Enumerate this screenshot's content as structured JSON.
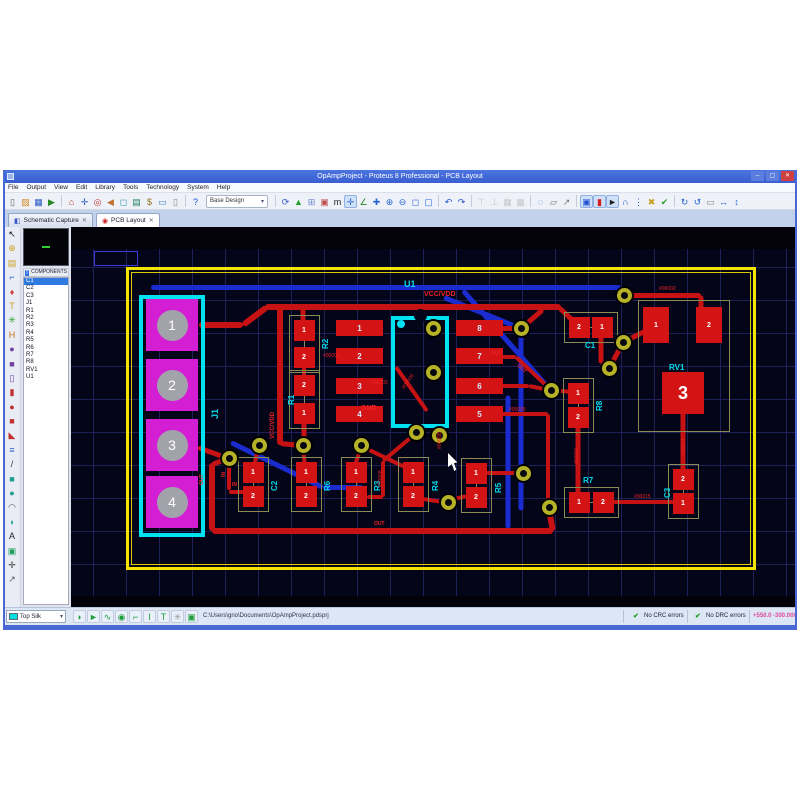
{
  "window": {
    "title": "OpAmpProject - Proteus 8 Professional - PCB Layout",
    "minimize_label": "–",
    "maximize_label": "▢",
    "close_label": "✕"
  },
  "menu": {
    "items": [
      "File",
      "Output",
      "View",
      "Edit",
      "Library",
      "Tools",
      "Technology",
      "System",
      "Help"
    ]
  },
  "toolbar": {
    "base_design": "Base Design",
    "icons": [
      [
        "new-file",
        "▯",
        "#666"
      ],
      [
        "open-project",
        "▨",
        "#d08820"
      ],
      [
        "save-project",
        "▦",
        "#2858c8"
      ],
      [
        "import-section",
        "▶",
        "#288828"
      ],
      [
        "sep"
      ],
      [
        "home",
        "⌂",
        "#b04030"
      ],
      [
        "goto-sheet",
        "✛",
        "#2858c8"
      ],
      [
        "center-at",
        "◎",
        "#c03030"
      ],
      [
        "undo-view",
        "◀",
        "#c07030"
      ],
      [
        "zoom-view",
        "◻",
        "#2898a8"
      ],
      [
        "design-explorer",
        "▤",
        "#208060"
      ],
      [
        "bill-of-materials",
        "$",
        "#907020"
      ],
      [
        "electrical-rule-check",
        "▭",
        "#4080c0"
      ],
      [
        "new-sheet",
        "▯",
        "#888"
      ],
      [
        "sep"
      ],
      [
        "help",
        "?",
        "#1850d0"
      ],
      [
        "select-base-design"
      ],
      [
        "sep"
      ],
      [
        "redraw",
        "⟳",
        "#2858c8"
      ],
      [
        "flip-layer",
        "▲",
        "#28a028"
      ],
      [
        "grid-toggle",
        "⊞",
        "#6888c8"
      ],
      [
        "layer-colours",
        "▣",
        "#c05050"
      ],
      [
        "metric-toggle",
        "m",
        "#222"
      ],
      [
        "origin",
        "✛",
        "#2868d8",
        "s"
      ],
      [
        "x-cursor",
        "∠",
        "#288828"
      ],
      [
        "pan",
        "✚",
        "#2868d8"
      ],
      [
        "zoom-in",
        "⊕",
        "#2868d8"
      ],
      [
        "zoom-out",
        "⊖",
        "#2868d8"
      ],
      [
        "zoom-area",
        "◻",
        "#2868d8"
      ],
      [
        "zoom-all",
        "▢",
        "#2868d8"
      ],
      [
        "sep"
      ],
      [
        "undo",
        "↶",
        "#2050d0"
      ],
      [
        "redo",
        "↷",
        "#2050d0"
      ],
      [
        "sep"
      ],
      [
        "align-top",
        "⊤",
        "#999",
        "d"
      ],
      [
        "align-bottom",
        "⊥",
        "#999",
        "d"
      ],
      [
        "align-left",
        "▦",
        "#999",
        "d"
      ],
      [
        "align-right",
        "▩",
        "#999",
        "d"
      ],
      [
        "sep"
      ],
      [
        "search-tag",
        "◌",
        "#2868d8"
      ],
      [
        "copy-clip",
        "▱",
        "#777"
      ],
      [
        "tools",
        "↗",
        "#777"
      ],
      [
        "sep"
      ],
      [
        "trace-lock",
        "▣",
        "#2050d0",
        "s"
      ],
      [
        "pin-mode",
        "▮",
        "#d02020",
        "s"
      ],
      [
        "selection-filter",
        "►",
        "#222",
        "s"
      ],
      [
        "auto-router",
        "∩",
        "#2050d0"
      ],
      [
        "design-rule-manager",
        "⋮",
        "#2050d0"
      ],
      [
        "ratsnest-toggle",
        "✖",
        "#c8a020"
      ],
      [
        "connectivity-check",
        "✔",
        "#28a028"
      ],
      [
        "sep"
      ],
      [
        "rotate-cw",
        "↻",
        "#2060d0"
      ],
      [
        "rotate-ccw",
        "↺",
        "#2060d0"
      ],
      [
        "rotation-value",
        "▭",
        "#888"
      ],
      [
        "flip-horizontal",
        "↔",
        "#2060d0"
      ],
      [
        "flip-vertical",
        "↕",
        "#2060d0"
      ]
    ]
  },
  "tabs": [
    {
      "label": "Schematic Capture",
      "icon_glyph": "◧",
      "icon_color": "#3a58c8",
      "close": "✕",
      "active": false
    },
    {
      "label": "PCB Layout",
      "icon_glyph": "◉",
      "icon_color": "#cc2222",
      "close": "✕",
      "active": true
    }
  ],
  "sidebar": {
    "panel_title": "COMPONENTS",
    "header_icon": "T",
    "selected": "C1",
    "components": [
      "C1",
      "C2",
      "C3",
      "J1",
      "R1",
      "R2",
      "R3",
      "R4",
      "R5",
      "R6",
      "R7",
      "R8",
      "RV1",
      "U1"
    ],
    "tool_icons": [
      [
        "selection-mode",
        "↖",
        "#111"
      ],
      [
        "component-mode",
        "⊕",
        "#c8a020"
      ],
      [
        "package-mode",
        "▤",
        "#c8a020"
      ],
      [
        "track-mode",
        "⌐",
        "#2858d8"
      ],
      [
        "via-mode",
        "♦",
        "#d04040"
      ],
      [
        "zone-mode",
        "T",
        "#c8a020"
      ],
      [
        "ratsnest-mode",
        "✳",
        "#28a028"
      ],
      [
        "connectivity-highlight-mode",
        "H",
        "#c87020"
      ],
      [
        "round-pad-mode",
        "●",
        "#7040a0"
      ],
      [
        "square-pad-mode",
        "■",
        "#7040a0"
      ],
      [
        "dil-pad-mode",
        "▯",
        "#7040a0"
      ],
      [
        "edge-pad-mode",
        "▮",
        "#c03030"
      ],
      [
        "circular-pad-mode",
        "●",
        "#c03030"
      ],
      [
        "rect-pad-mode",
        "■",
        "#c03030"
      ],
      [
        "polygonal-pad-mode",
        "◣",
        "#c03030"
      ],
      [
        "layer-stack",
        "≡",
        "#3060d0"
      ],
      [
        "2d-line",
        "/",
        "#333"
      ],
      [
        "2d-box",
        "■",
        "#1f9e8e"
      ],
      [
        "2d-circle",
        "●",
        "#1f9e8e"
      ],
      [
        "2d-arc",
        "◠",
        "#555"
      ],
      [
        "2d-path",
        "◗",
        "#1f9e8e"
      ],
      [
        "2d-text",
        "A",
        "#222"
      ],
      [
        "2d-symbol",
        "▣",
        "#1f9e60"
      ],
      [
        "origin-marker",
        "✛",
        "#333"
      ],
      [
        "dimension-mode",
        "↗",
        "#555"
      ]
    ]
  },
  "statusbar": {
    "layer_selector": "Top Silk",
    "layer_swatch": "#00e0e0",
    "icons": [
      [
        "layer-flip",
        "◗",
        "#1f9e3e"
      ],
      [
        "track-arrow",
        "►",
        "#1f9e3e"
      ],
      [
        "trace-style",
        "∿",
        "#1f9e3e"
      ],
      [
        "via-style",
        "◉",
        "#1f9e3e"
      ],
      [
        "corner-mode",
        "⌐",
        "#1f9e3e"
      ],
      [
        "track-width",
        "I",
        "#1f9e3e"
      ],
      [
        "tee-junction",
        "T",
        "#1f9e3e"
      ],
      [
        "ratsnest-view",
        "✳",
        "#999"
      ],
      [
        "log-view",
        "▣",
        "#1f9e3e"
      ]
    ],
    "file_path": "C:\\Users\\gno\\Documents\\OpAmpProject.pdsprj",
    "crc_check": "✔",
    "crc_status": "No CRC errors",
    "drc_check": "✔",
    "drc_status": "No DRC errors",
    "coord_x": "+550.0",
    "coord_y": "-300.0",
    "coord_units": "th"
  },
  "pcb": {
    "board": {
      "x": 55,
      "y": 40,
      "w": 630,
      "h": 303
    },
    "selection_box": {
      "x": 23,
      "y": 24,
      "w": 44,
      "h": 15
    },
    "traces_blue": [
      [
        80,
        60,
        550,
        60,
        5
      ],
      [
        373,
        70,
        450,
        101,
        5
      ],
      [
        450,
        101,
        450,
        246,
        5
      ],
      [
        392,
        63,
        478,
        161,
        5
      ],
      [
        437,
        168,
        437,
        301,
        5
      ],
      [
        160,
        215,
        252,
        260,
        5
      ],
      [
        252,
        260,
        292,
        260,
        5
      ],
      [
        450,
        246,
        450,
        283,
        5
      ]
    ],
    "traces_red": [
      [
        128,
        98,
        172,
        98,
        6
      ],
      [
        172,
        98,
        196,
        80,
        6
      ],
      [
        194,
        80,
        490,
        80,
        6
      ],
      [
        488,
        80,
        506,
        97,
        5
      ],
      [
        232,
        80,
        232,
        103,
        5
      ],
      [
        209,
        80,
        209,
        218,
        6
      ],
      [
        209,
        216,
        230,
        218,
        5
      ],
      [
        233,
        190,
        233,
        216,
        5
      ],
      [
        233,
        132,
        233,
        158,
        4
      ],
      [
        430,
        101,
        450,
        101,
        5
      ],
      [
        450,
        101,
        472,
        82,
        5
      ],
      [
        530,
        104,
        530,
        136,
        5
      ],
      [
        530,
        136,
        538,
        141,
        4
      ],
      [
        538,
        141,
        552,
        115,
        5
      ],
      [
        552,
        115,
        583,
        99,
        5
      ],
      [
        553,
        68,
        630,
        68,
        5
      ],
      [
        630,
        68,
        630,
        85,
        5
      ],
      [
        430,
        130,
        445,
        130,
        4
      ],
      [
        445,
        130,
        480,
        163,
        4
      ],
      [
        480,
        163,
        500,
        165,
        4
      ],
      [
        430,
        159,
        458,
        159,
        4
      ],
      [
        458,
        159,
        478,
        163,
        4
      ],
      [
        507,
        193,
        507,
        273,
        5
      ],
      [
        540,
        275,
        603,
        275,
        4
      ],
      [
        612,
        182,
        612,
        251,
        5
      ],
      [
        430,
        187,
        477,
        187,
        4
      ],
      [
        477,
        187,
        477,
        278,
        4
      ],
      [
        141,
        304,
        482,
        304,
        6
      ],
      [
        482,
        304,
        478,
        283,
        6
      ],
      [
        141,
        236,
        141,
        304,
        6
      ],
      [
        141,
        237,
        157,
        231,
        5
      ],
      [
        127,
        220,
        157,
        231,
        5
      ],
      [
        158,
        233,
        158,
        263,
        4
      ],
      [
        158,
        265,
        173,
        265,
        4
      ],
      [
        187,
        222,
        183,
        239,
        4
      ],
      [
        232,
        221,
        234,
        240,
        4
      ],
      [
        290,
        221,
        284,
        238,
        4
      ],
      [
        292,
        220,
        340,
        243,
        4
      ],
      [
        296,
        270,
        312,
        270,
        4
      ],
      [
        312,
        270,
        312,
        234,
        4
      ],
      [
        312,
        234,
        344,
        207,
        4
      ],
      [
        352,
        272,
        372,
        275,
        4
      ],
      [
        379,
        273,
        396,
        269,
        4
      ],
      [
        415,
        246,
        448,
        246,
        4
      ],
      [
        325,
        140,
        356,
        184,
        4
      ]
    ],
    "vias": [
      [
        158,
        231
      ],
      [
        188,
        218
      ],
      [
        232,
        218
      ],
      [
        290,
        218
      ],
      [
        345,
        205
      ],
      [
        368,
        208
      ],
      [
        377,
        275
      ],
      [
        452,
        246
      ],
      [
        478,
        280
      ],
      [
        450,
        101
      ],
      [
        480,
        163
      ],
      [
        538,
        141
      ],
      [
        552,
        115
      ],
      [
        553,
        68
      ],
      [
        362,
        101
      ],
      [
        362,
        145
      ]
    ],
    "j1": {
      "box": [
        68,
        68,
        66,
        242
      ],
      "label": "J1",
      "label_x": 139,
      "label_y": 192,
      "pad_x": 101,
      "pads": [
        {
          "n": "1",
          "y": 98
        },
        {
          "n": "2",
          "y": 158
        },
        {
          "n": "3",
          "y": 218
        },
        {
          "n": "4",
          "y": 275
        }
      ]
    },
    "u1": {
      "box": [
        320,
        89,
        58,
        112
      ],
      "rows": [
        101,
        129,
        159,
        187
      ],
      "left_nums": [
        "1",
        "2",
        "3",
        "4"
      ],
      "right_nums": [
        "8",
        "7",
        "6",
        "5"
      ],
      "pad_left_x": 265,
      "pad_right_x": 385,
      "pad_w": 47,
      "pad_h": 16
    },
    "components": [
      {
        "name": "R2",
        "label_rot": -90,
        "label_x": 250,
        "label_y": 122,
        "pads": [
          {
            "n": "1",
            "x": 233,
            "y": 103
          },
          {
            "n": "2",
            "x": 233,
            "y": 130
          }
        ]
      },
      {
        "name": "R1",
        "label_rot": -90,
        "label_x": 216,
        "label_y": 178,
        "pads": [
          {
            "n": "2",
            "x": 233,
            "y": 158
          },
          {
            "n": "1",
            "x": 233,
            "y": 186
          }
        ]
      },
      {
        "name": "C1",
        "label_rot": 0,
        "label_x": 514,
        "label_y": 114,
        "pads": [
          {
            "n": "2",
            "x": 508,
            "y": 100
          },
          {
            "n": "1",
            "x": 531,
            "y": 100
          }
        ]
      },
      {
        "name": "R8",
        "label_rot": -90,
        "label_x": 524,
        "label_y": 184,
        "pads": [
          {
            "n": "1",
            "x": 507,
            "y": 166
          },
          {
            "n": "2",
            "x": 507,
            "y": 190
          }
        ]
      },
      {
        "name": "C2",
        "label_rot": -90,
        "label_x": 199,
        "label_y": 264,
        "pads": [
          {
            "n": "1",
            "x": 182,
            "y": 245
          },
          {
            "n": "2",
            "x": 182,
            "y": 269
          }
        ]
      },
      {
        "name": "R6",
        "label_rot": -90,
        "label_x": 252,
        "label_y": 264,
        "pads": [
          {
            "n": "1",
            "x": 235,
            "y": 245
          },
          {
            "n": "2",
            "x": 235,
            "y": 269
          }
        ]
      },
      {
        "name": "R3",
        "label_rot": -90,
        "label_x": 302,
        "label_y": 264,
        "pads": [
          {
            "n": "1",
            "x": 285,
            "y": 245
          },
          {
            "n": "2",
            "x": 285,
            "y": 269
          }
        ]
      },
      {
        "name": "R4",
        "label_rot": -90,
        "label_x": 360,
        "label_y": 264,
        "pads": [
          {
            "n": "1",
            "x": 342,
            "y": 245
          },
          {
            "n": "2",
            "x": 342,
            "y": 269
          }
        ]
      },
      {
        "name": "R5",
        "label_rot": -90,
        "label_x": 423,
        "label_y": 266,
        "pads": [
          {
            "n": "1",
            "x": 405,
            "y": 246
          },
          {
            "n": "2",
            "x": 405,
            "y": 270
          }
        ]
      },
      {
        "name": "R7",
        "label_rot": 0,
        "label_x": 512,
        "label_y": 249,
        "pads": [
          {
            "n": "1",
            "x": 508,
            "y": 275
          },
          {
            "n": "2",
            "x": 532,
            "y": 275
          }
        ]
      },
      {
        "name": "C3",
        "label_rot": -90,
        "label_x": 592,
        "label_y": 271,
        "pads": [
          {
            "n": "2",
            "x": 612,
            "y": 252
          },
          {
            "n": "1",
            "x": 612,
            "y": 276
          }
        ]
      },
      {
        "name": "RV1",
        "label_rot": 0,
        "label_x": 598,
        "label_y": 136,
        "box": [
          567,
          73,
          92,
          132
        ],
        "pads": [
          {
            "n": "1",
            "x": 585,
            "y": 98,
            "w": 26,
            "h": 36
          },
          {
            "n": "2",
            "x": 638,
            "y": 98,
            "w": 26,
            "h": 36
          },
          {
            "n": "3",
            "x": 612,
            "y": 166,
            "w": 42,
            "h": 42,
            "fs": 18
          }
        ]
      }
    ],
    "net_labels": [
      {
        "t": "#00001",
        "x": 252,
        "y": 126,
        "r": 0
      },
      {
        "t": "#00002",
        "x": 588,
        "y": 59,
        "r": 0
      },
      {
        "t": "#00003",
        "x": 300,
        "y": 153,
        "r": 0
      },
      {
        "t": "#00005",
        "x": 438,
        "y": 180,
        "r": 0
      },
      {
        "t": "#00006",
        "x": 503,
        "y": 237,
        "r": -90
      },
      {
        "t": "#00008",
        "x": 307,
        "y": 260,
        "r": -90
      },
      {
        "t": "#00008",
        "x": 366,
        "y": 222,
        "r": -90
      },
      {
        "t": "#00009",
        "x": 330,
        "y": 160,
        "r": -55
      },
      {
        "t": "#00015",
        "x": 563,
        "y": 267,
        "r": 0
      },
      {
        "t": "#00017",
        "x": 610,
        "y": 228,
        "r": -90
      }
    ],
    "labels": [
      {
        "t": "U1",
        "x": 333,
        "y": 52,
        "c": "cyan",
        "s": 9,
        "r": 0
      },
      {
        "t": "VCC/VDD",
        "x": 353,
        "y": 64,
        "c": "red",
        "s": 7,
        "r": 0
      },
      {
        "t": "GND",
        "x": 290,
        "y": 178,
        "c": "red",
        "s": 7,
        "r": 0
      },
      {
        "t": "VCC/VDD",
        "x": 199,
        "y": 212,
        "c": "red",
        "s": 6,
        "r": -90
      },
      {
        "t": "OUT",
        "x": 420,
        "y": 124,
        "c": "red",
        "s": 5,
        "r": 0
      },
      {
        "t": "OUT",
        "x": 449,
        "y": 136,
        "c": "red",
        "s": 5,
        "r": 45
      },
      {
        "t": "OUT",
        "x": 303,
        "y": 294,
        "c": "red",
        "s": 5,
        "r": 0
      },
      {
        "t": "OUT",
        "x": 128,
        "y": 258,
        "c": "red",
        "s": 5,
        "r": -90
      },
      {
        "t": "IN",
        "x": 161,
        "y": 255,
        "c": "red",
        "s": 5,
        "r": 0
      },
      {
        "t": "IN",
        "x": 150,
        "y": 250,
        "c": "red",
        "s": 5,
        "r": -90
      }
    ],
    "cursor": {
      "x": 377,
      "y": 226
    }
  }
}
